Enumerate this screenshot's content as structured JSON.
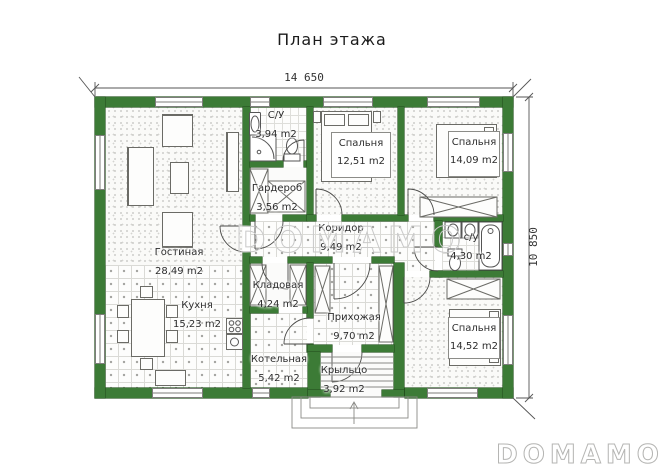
{
  "title": "План этажа",
  "dimensions": {
    "width_label": "14 650",
    "height_label": "10 850"
  },
  "watermark": "DOMAMO",
  "logo": "DOMAMO",
  "rooms": [
    {
      "name": "Гостиная",
      "area": "28,49 m2"
    },
    {
      "name": "Кухня",
      "area": "15,23 m2"
    },
    {
      "name": "С/У",
      "area": "3,94 m2"
    },
    {
      "name": "Гардероб",
      "area": "3,56 m2"
    },
    {
      "name": "Спальня",
      "area": "12,51 m2"
    },
    {
      "name": "Спальня",
      "area": "14,09 m2"
    },
    {
      "name": "Коридор",
      "area": "9,49 m2"
    },
    {
      "name": "Кладовая",
      "area": "4,24 m2"
    },
    {
      "name": "Прихожая",
      "area": "9,70 m2"
    },
    {
      "name": "Котельная",
      "area": "5,42 m2"
    },
    {
      "name": "с/у",
      "area": "4,30 m2"
    },
    {
      "name": "Спальня",
      "area": "14,52 m2"
    },
    {
      "name": "Крыльцо",
      "area": "3,92 m2"
    }
  ]
}
